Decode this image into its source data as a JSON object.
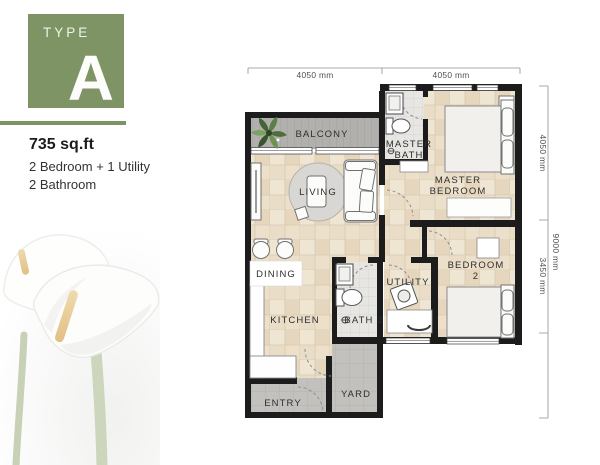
{
  "badge": {
    "type_label": "TYPE",
    "type_letter": "A"
  },
  "summary": {
    "area": "735 sq.ft",
    "bedrooms": "2 Bedroom + 1 Utility",
    "bathrooms": "2 Bathroom"
  },
  "dimensions": {
    "top": [
      "4050 mm",
      "4050 mm"
    ],
    "right": [
      "4050 mm",
      "3450 mm"
    ],
    "right_total": "9000 mm"
  },
  "rooms": {
    "balcony": "BALCONY",
    "living": "LIVING",
    "dining": "DINING",
    "kitchen": "KITCHEN",
    "bath2": "BATH 2",
    "utility": "UTILITY",
    "yard": "YARD",
    "entry": "ENTRY",
    "master_bath": [
      "MASTER",
      "BATH"
    ],
    "master_bedroom": [
      "MASTER",
      "BEDROOM"
    ],
    "bedroom2": [
      "BEDROOM",
      "2"
    ]
  },
  "colors": {
    "accent_green": "#7e9464",
    "wall": "#1c1c1c",
    "tile_floor": "#ebe0cd",
    "balcony_floor": "#b2b0ad",
    "outdoor_floor": "#c3c1be",
    "bath_floor": "#e7e6e3"
  }
}
